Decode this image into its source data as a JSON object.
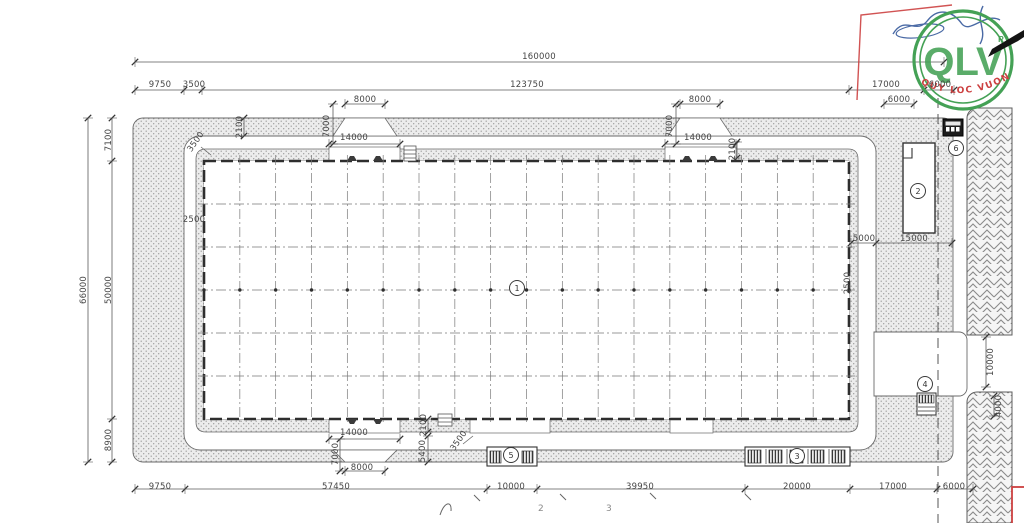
{
  "drawing": {
    "dimension_labels": [
      {
        "text": "160000",
        "x": 539,
        "y": 57
      },
      {
        "text": "9750",
        "x": 160,
        "y": 85
      },
      {
        "text": "3500",
        "x": 194,
        "y": 85
      },
      {
        "text": "123750",
        "x": 527,
        "y": 85
      },
      {
        "text": "17000",
        "x": 886,
        "y": 85
      },
      {
        "text": "6000",
        "x": 940,
        "y": 85
      },
      {
        "text": "6000",
        "x": 899,
        "y": 100
      },
      {
        "text": "8000",
        "x": 365,
        "y": 100
      },
      {
        "text": "8000",
        "x": 700,
        "y": 100
      },
      {
        "text": "14000",
        "x": 354,
        "y": 138
      },
      {
        "text": "14000",
        "x": 698,
        "y": 138
      },
      {
        "text": "7000",
        "x": 327,
        "y": 126,
        "rot": -90
      },
      {
        "text": "7000",
        "x": 670,
        "y": 126,
        "rot": -90
      },
      {
        "text": "2100",
        "x": 240,
        "y": 127,
        "rot": -90
      },
      {
        "text": "2100",
        "x": 733,
        "y": 149,
        "rot": -90
      },
      {
        "text": "3500",
        "x": 196,
        "y": 142,
        "rot": -55
      },
      {
        "text": "66000",
        "x": 84,
        "y": 290,
        "rot": -90
      },
      {
        "text": "7100",
        "x": 109,
        "y": 140,
        "rot": -90
      },
      {
        "text": "50000",
        "x": 109,
        "y": 290,
        "rot": -90
      },
      {
        "text": "8900",
        "x": 109,
        "y": 440,
        "rot": -90
      },
      {
        "text": "2500",
        "x": 194,
        "y": 220
      },
      {
        "text": "5000",
        "x": 864,
        "y": 239
      },
      {
        "text": "15000",
        "x": 914,
        "y": 239
      },
      {
        "text": "2500",
        "x": 848,
        "y": 283,
        "rot": -90
      },
      {
        "text": "10000",
        "x": 991,
        "y": 362,
        "rot": -90
      },
      {
        "text": "4000",
        "x": 999,
        "y": 406,
        "rot": -90
      },
      {
        "text": "2100",
        "x": 424,
        "y": 425,
        "rot": -90
      },
      {
        "text": "14000",
        "x": 354,
        "y": 433
      },
      {
        "text": "7000",
        "x": 336,
        "y": 454,
        "rot": -90
      },
      {
        "text": "3500",
        "x": 459,
        "y": 441,
        "rot": -55
      },
      {
        "text": "5400",
        "x": 423,
        "y": 451,
        "rot": -90
      },
      {
        "text": "8000",
        "x": 362,
        "y": 468
      },
      {
        "text": "9750",
        "x": 160,
        "y": 487
      },
      {
        "text": "57450",
        "x": 336,
        "y": 487
      },
      {
        "text": "10000",
        "x": 511,
        "y": 487
      },
      {
        "text": "39950",
        "x": 640,
        "y": 487
      },
      {
        "text": "20000",
        "x": 797,
        "y": 487
      },
      {
        "text": "17000",
        "x": 893,
        "y": 487
      },
      {
        "text": "6000",
        "x": 954,
        "y": 487
      },
      {
        "text": "2",
        "x": 541,
        "y": 509,
        "cls": "faint"
      },
      {
        "text": "3",
        "x": 609,
        "y": 509,
        "cls": "faint"
      }
    ],
    "balloons": [
      {
        "n": "1",
        "x": 517,
        "y": 288
      },
      {
        "n": "2",
        "x": 918,
        "y": 191
      },
      {
        "n": "3",
        "x": 797,
        "y": 456
      },
      {
        "n": "4",
        "x": 925,
        "y": 384
      },
      {
        "n": "5",
        "x": 511,
        "y": 455
      },
      {
        "n": "6",
        "x": 956,
        "y": 148
      }
    ]
  },
  "stamp": {
    "letters": "QLV",
    "registered": "R",
    "arc_text": "QUY LOC VUONG",
    "ring_color": "#44a155",
    "letters_color": "#44a155",
    "arc_color": "#cc4040",
    "signature_color": "#4a6aa5"
  },
  "colors": {
    "line": "#4a4a4a",
    "wall": "#2e2e2e",
    "stipple_bg": "#ececec",
    "stipple_dot": "#9b9b9b",
    "hatch": "#8a8a8a"
  }
}
